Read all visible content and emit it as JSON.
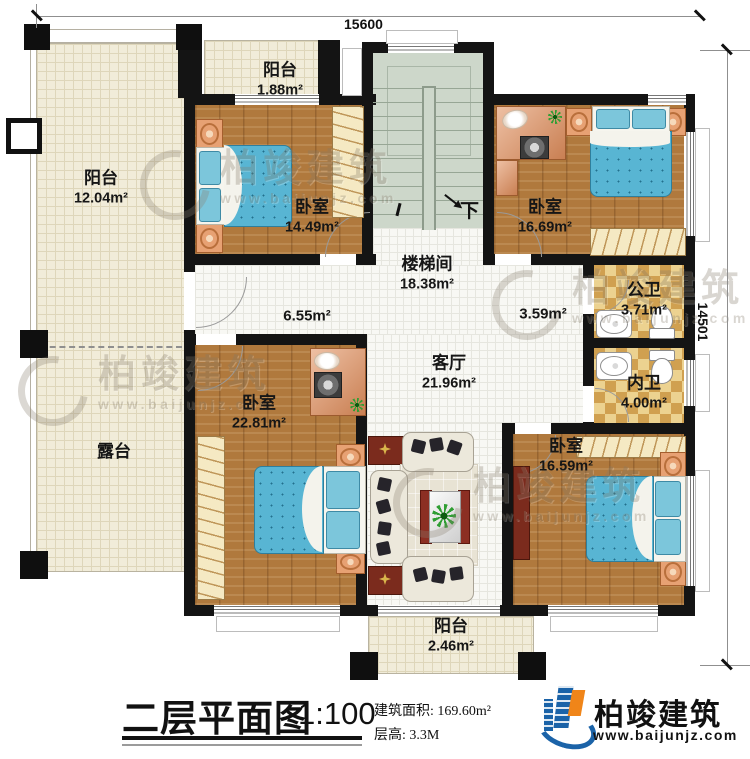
{
  "dims": {
    "width": "15600",
    "height": "14501"
  },
  "rooms": {
    "balcony_left": {
      "name": "阳台",
      "area": "12.04m²"
    },
    "terrace": {
      "name": "露台"
    },
    "balcony_top": {
      "name": "阳台",
      "area": "1.88m²"
    },
    "bedroom_tl": {
      "name": "卧室",
      "area": "14.49m²"
    },
    "stairwell": {
      "name": "楼梯间",
      "area": "18.38m²"
    },
    "bedroom_tr": {
      "name": "卧室",
      "area": "16.69m²"
    },
    "hall": {
      "area": "6.55m²"
    },
    "hall_bath": {
      "area": "3.59m²"
    },
    "bath_public": {
      "name": "公卫",
      "area": "3.71m²"
    },
    "bath_private": {
      "name": "内卫",
      "area": "4.00m²"
    },
    "living": {
      "name": "客厅",
      "area": "21.96m²"
    },
    "bedroom_bl": {
      "name": "卧室",
      "area": "22.81m²"
    },
    "bedroom_br": {
      "name": "卧室",
      "area": "16.59m²"
    },
    "balcony_bottom": {
      "name": "阳台",
      "area": "2.46m²"
    }
  },
  "stairs": {
    "down": "下"
  },
  "titleblock": {
    "title": "二层平面图",
    "scale": "1:100",
    "build_area": "建筑面积: 169.60m²",
    "floor_height": "层高: 3.3M"
  },
  "brand": {
    "name": "柏竣建筑",
    "url": "www.baijunjz.com"
  },
  "colors": {
    "wall": "#141414",
    "wood": "#b0793d",
    "bed_blue": "#58b5d3",
    "stair_green": "#cdd7ca",
    "checker_tan": "#d0a050",
    "logo_blue": "#1b63a8",
    "logo_orange": "#f08519"
  }
}
